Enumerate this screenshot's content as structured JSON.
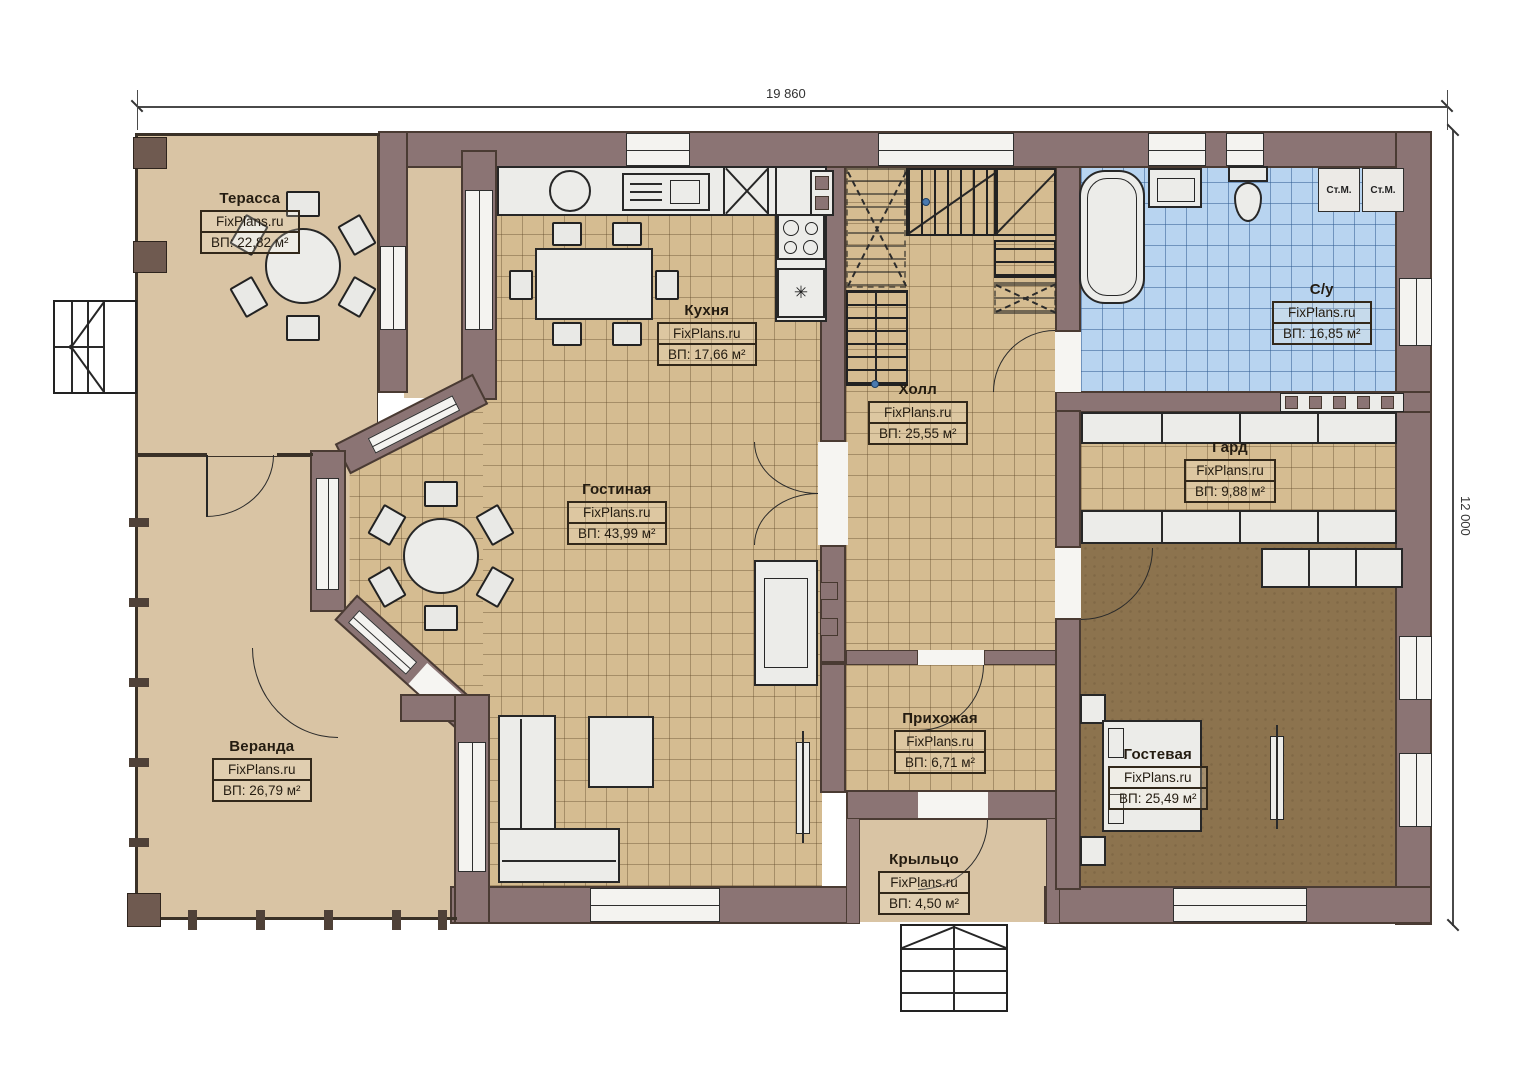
{
  "dimensions": {
    "width_label": "19 860",
    "height_label": "12 000"
  },
  "brand": "FixPlans.ru",
  "rooms": [
    {
      "key": "terrace",
      "name": "Терасса",
      "area": "ВП: 22,82 м²"
    },
    {
      "key": "kitchen",
      "name": "Кухня",
      "area": "ВП: 17,66 м²"
    },
    {
      "key": "hall",
      "name": "Холл",
      "area": "ВП: 25,55 м²"
    },
    {
      "key": "bathroom",
      "name": "С/у",
      "area": "ВП: 16,85 м²"
    },
    {
      "key": "wardrobe",
      "name": "Гард",
      "area": "ВП: 9,88 м²"
    },
    {
      "key": "living",
      "name": "Гостиная",
      "area": "ВП: 43,99 м²"
    },
    {
      "key": "veranda",
      "name": "Веранда",
      "area": "ВП: 26,79 м²"
    },
    {
      "key": "entry",
      "name": "Прихожая",
      "area": "ВП: 6,71 м²"
    },
    {
      "key": "guest",
      "name": "Гостевая",
      "area": "ВП: 25,49 м²"
    },
    {
      "key": "porch",
      "name": "Крыльцо",
      "area": "ВП: 4,50 м²"
    }
  ],
  "appliances": {
    "washer_1": "Ст.М.",
    "washer_2": "Ст.М.",
    "freezer_symbol": "✳"
  },
  "colors": {
    "wall": "#8b7474",
    "warm_floor": "#d9c4a4",
    "tile_floor": "#d5bc91",
    "bath_floor": "#b8d4f0",
    "carpet": "#8c734e"
  }
}
